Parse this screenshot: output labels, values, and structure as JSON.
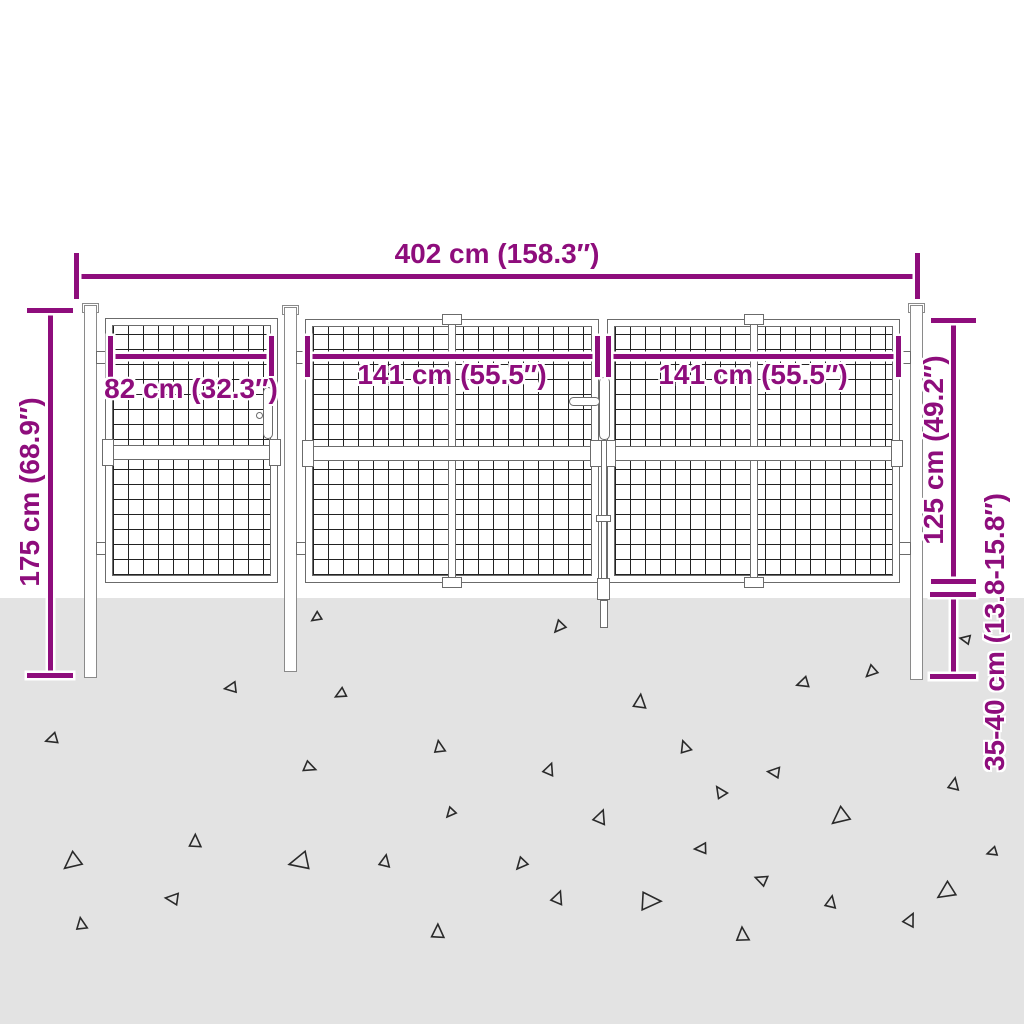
{
  "scene": {
    "accent_color": "#8e0d7c",
    "ground_color": "#e3e3e3",
    "mesh_line_color": "#222222",
    "frame_color": "#6b6b6b",
    "background_color": "#ffffff"
  },
  "labels": {
    "total_width": "402 cm (158.3″)",
    "post_height": "175 cm (68.9″)",
    "small_gate_width": "82 cm (32.3″)",
    "left_gate_width": "141 cm (55.5″)",
    "right_gate_width": "141 cm (55.5″)",
    "gate_height": "125 cm (49.2″)",
    "below_ground_depth": "35-40 cm (13.8-15.8″)"
  },
  "ground": {
    "top": 598,
    "triangles": [
      [
        313,
        612,
        10,
        15
      ],
      [
        227,
        682,
        12,
        40
      ],
      [
        337,
        688,
        11,
        20
      ],
      [
        48,
        733,
        12,
        30
      ],
      [
        433,
        743,
        12,
        130
      ],
      [
        302,
        760,
        12,
        250
      ],
      [
        447,
        807,
        10,
        0
      ],
      [
        188,
        837,
        13,
        140
      ],
      [
        66,
        852,
        18,
        10
      ],
      [
        293,
        852,
        20,
        35
      ],
      [
        378,
        857,
        12,
        150
      ],
      [
        168,
        893,
        13,
        55
      ],
      [
        75,
        920,
        12,
        130
      ],
      [
        430,
        927,
        14,
        140
      ],
      [
        555,
        620,
        12,
        0
      ],
      [
        962,
        635,
        10,
        60
      ],
      [
        867,
        665,
        12,
        5
      ],
      [
        799,
        677,
        12,
        30
      ],
      [
        632,
        697,
        14,
        145
      ],
      [
        679,
        743,
        12,
        120
      ],
      [
        542,
        765,
        12,
        160
      ],
      [
        770,
        767,
        12,
        55
      ],
      [
        715,
        788,
        12,
        105
      ],
      [
        834,
        807,
        18,
        10
      ],
      [
        947,
        780,
        12,
        150
      ],
      [
        592,
        812,
        14,
        160
      ],
      [
        697,
        843,
        12,
        45
      ],
      [
        517,
        857,
        12,
        0
      ],
      [
        757,
        875,
        12,
        70
      ],
      [
        550,
        893,
        13,
        160
      ],
      [
        637,
        890,
        20,
        230
      ],
      [
        824,
        898,
        12,
        150
      ],
      [
        940,
        882,
        18,
        15
      ],
      [
        989,
        847,
        10,
        30
      ],
      [
        902,
        915,
        13,
        165
      ],
      [
        735,
        930,
        14,
        135
      ]
    ]
  }
}
